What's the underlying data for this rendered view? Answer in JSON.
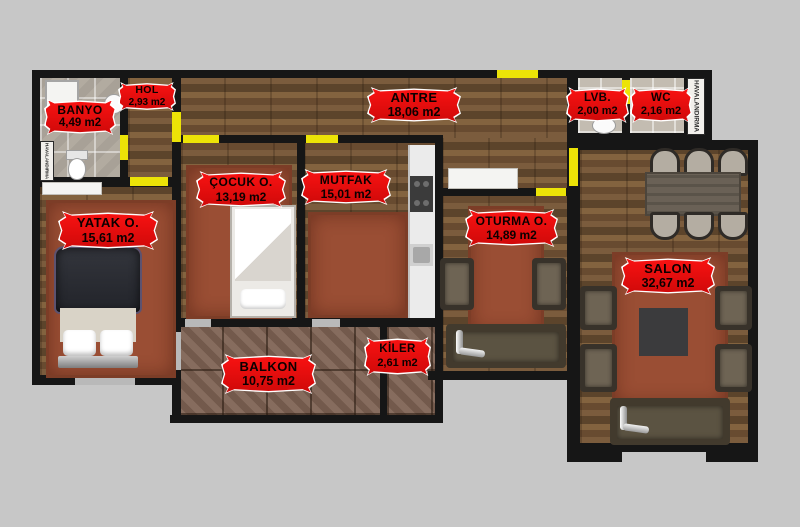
{
  "title": "apartment floor plan",
  "colors": {
    "background": "#c7c7c7",
    "wall": "#161616",
    "badge_red": "#ee0b0b",
    "door_marker_yellow": "#ece307",
    "wood_floor": "#6f5336",
    "stone_tile": "#7d6152",
    "bath_tile": "#b2aba0",
    "rug_rust": "#9a4e34"
  },
  "unit_suffix": "m2",
  "rooms": [
    {
      "id": "banyo",
      "name": "BANYO",
      "area": "4,49 m2"
    },
    {
      "id": "hol",
      "name": "HOL",
      "area": "2,93 m2"
    },
    {
      "id": "antre",
      "name": "ANTRE",
      "area": "18,06 m2"
    },
    {
      "id": "lvb",
      "name": "LVB.",
      "area": "2,00 m2"
    },
    {
      "id": "wc",
      "name": "WC",
      "area": "2,16 m2"
    },
    {
      "id": "yatak",
      "name": "YATAK O.",
      "area": "15,61 m2"
    },
    {
      "id": "cocuk",
      "name": "ÇOCUK O.",
      "area": "13,19 m2"
    },
    {
      "id": "mutfak",
      "name": "MUTFAK",
      "area": "15,01 m2"
    },
    {
      "id": "oturma",
      "name": "OTURMA O.",
      "area": "14,89 m2"
    },
    {
      "id": "salon",
      "name": "SALON",
      "area": "32,67 m2"
    },
    {
      "id": "balkon",
      "name": "BALKON",
      "area": "10,75 m2"
    },
    {
      "id": "kiler",
      "name": "KİLER",
      "area": "2,61 m2"
    }
  ],
  "vents": {
    "left": "HAVALANDIRMA",
    "right": "HAVALANDIRMA"
  }
}
